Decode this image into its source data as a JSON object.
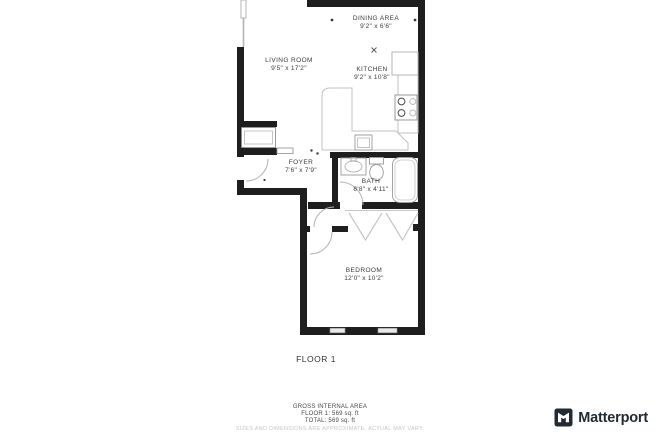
{
  "plan": {
    "rooms": [
      {
        "id": "dining-area",
        "name": "DINING AREA",
        "dims": "9'2\" x 6'6\""
      },
      {
        "id": "living-room",
        "name": "LIVING ROOM",
        "dims": "9'5\" x 17'2\""
      },
      {
        "id": "kitchen",
        "name": "KITCHEN",
        "dims": "9'2\" x 10'8\""
      },
      {
        "id": "foyer",
        "name": "FOYER",
        "dims": "7'6\" x 7'9\""
      },
      {
        "id": "bath",
        "name": "BATH",
        "dims": "8'8\" x 4'11\""
      },
      {
        "id": "bedroom",
        "name": "BEDROOM",
        "dims": "12'0\" x 10'2\""
      }
    ],
    "floor_label": "FLOOR 1"
  },
  "footer": {
    "area_title": "GROSS INTERNAL AREA",
    "floor_line": "FLOOR 1: 569 sq. ft",
    "total_line": "TOTAL: 569 sq. ft",
    "disclaimer": "SIZES AND DIMENSIONS ARE APPROXIMATE, ACTUAL MAY VARY."
  },
  "branding": {
    "logo_text": "Matterport"
  },
  "colors": {
    "wall": "#1e1e1e",
    "fixture": "#9a9a9a",
    "light_line": "#c6c6c6",
    "label_text": "#3c3c3c",
    "disclaimer_text": "#c7c7c7",
    "brand": "#222b33"
  }
}
